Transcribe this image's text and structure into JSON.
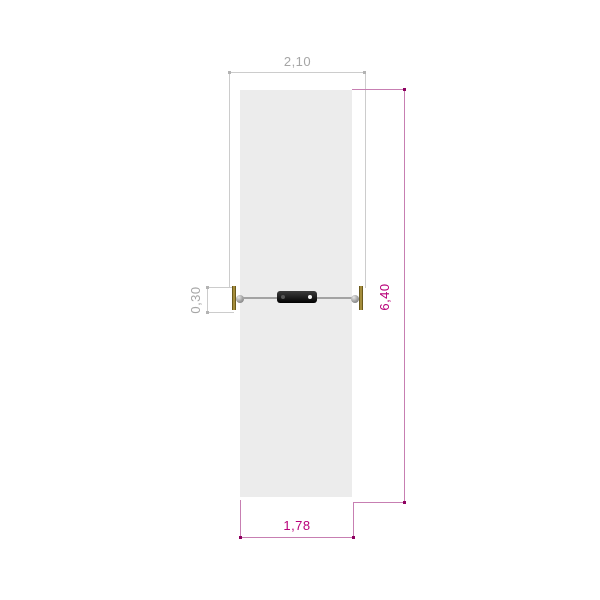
{
  "drawing": {
    "type": "technical-plan-view",
    "subject": "cable-balance-equipment-plan",
    "dimensions": [
      {
        "id": "overall-width-top",
        "value": "2,10",
        "orientation": "horizontal",
        "color_role": "secondary"
      },
      {
        "id": "anchor-height-left",
        "value": "0,30",
        "orientation": "vertical",
        "color_role": "secondary"
      },
      {
        "id": "overall-length-right",
        "value": "6,40",
        "orientation": "vertical",
        "color_role": "primary"
      },
      {
        "id": "area-width-bottom",
        "value": "1,78",
        "orientation": "horizontal",
        "color_role": "primary"
      }
    ]
  },
  "colors": {
    "gray-line": "#cccccc",
    "gray-dot": "#b3b3b3",
    "gray-text": "#a6a6a6",
    "magenta-line": "#c77fb2",
    "magenta-dot": "#8e005f",
    "magenta-text": "#b8007a",
    "area-fill": "#ececec",
    "cable": "#a3a3a3",
    "plate-fill": "#1d1d1d",
    "post-fill": "#a58d3c",
    "post-border": "#6b5a1c",
    "sphere-fill": "#9d9d9d"
  }
}
